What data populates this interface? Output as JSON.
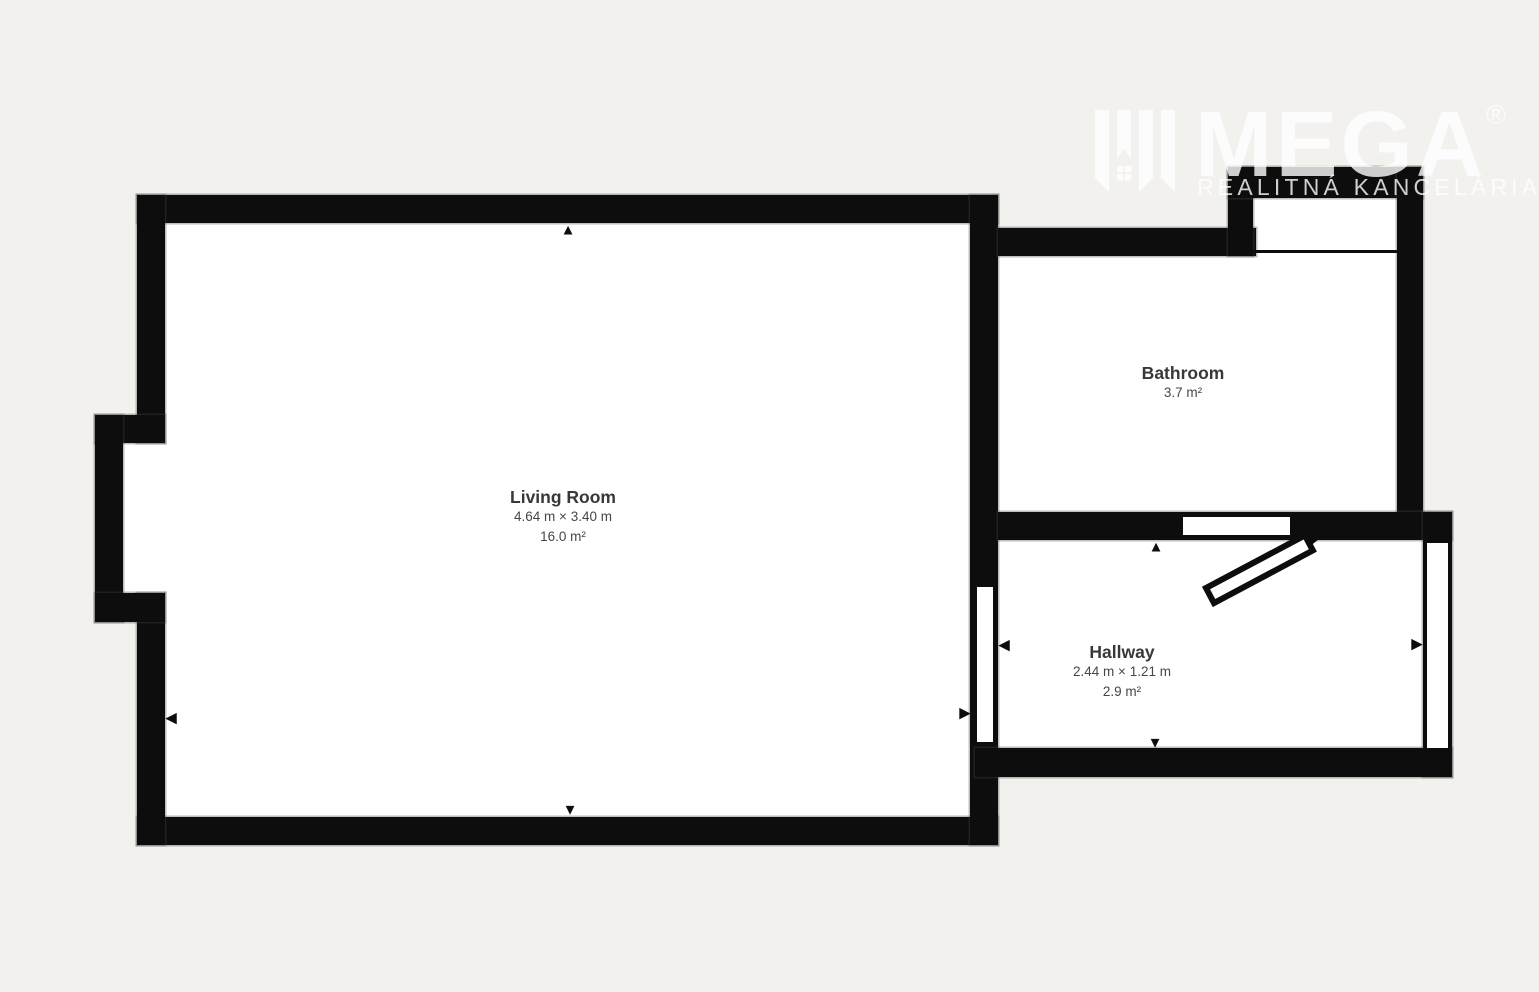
{
  "watermark": {
    "brand": "MEGA",
    "registered": "®",
    "tagline": "REALITNÁ KANCELÁRIA"
  },
  "rooms": [
    {
      "id": "living-room",
      "name": "Living Room",
      "dimensions": "4.64 m × 3.40 m",
      "area": "16.0 m²"
    },
    {
      "id": "bathroom",
      "name": "Bathroom",
      "dimensions": "",
      "area": "3.7 m²"
    },
    {
      "id": "hallway",
      "name": "Hallway",
      "dimensions": "2.44 m × 1.21 m",
      "area": "2.9 m²"
    }
  ],
  "colors": {
    "background": "#f2f1ee",
    "wall": "#0d0d0d",
    "interior": "#ffffff",
    "label_text": "#3b3b3b",
    "watermark": "rgba(255,255,255,0.8)"
  }
}
